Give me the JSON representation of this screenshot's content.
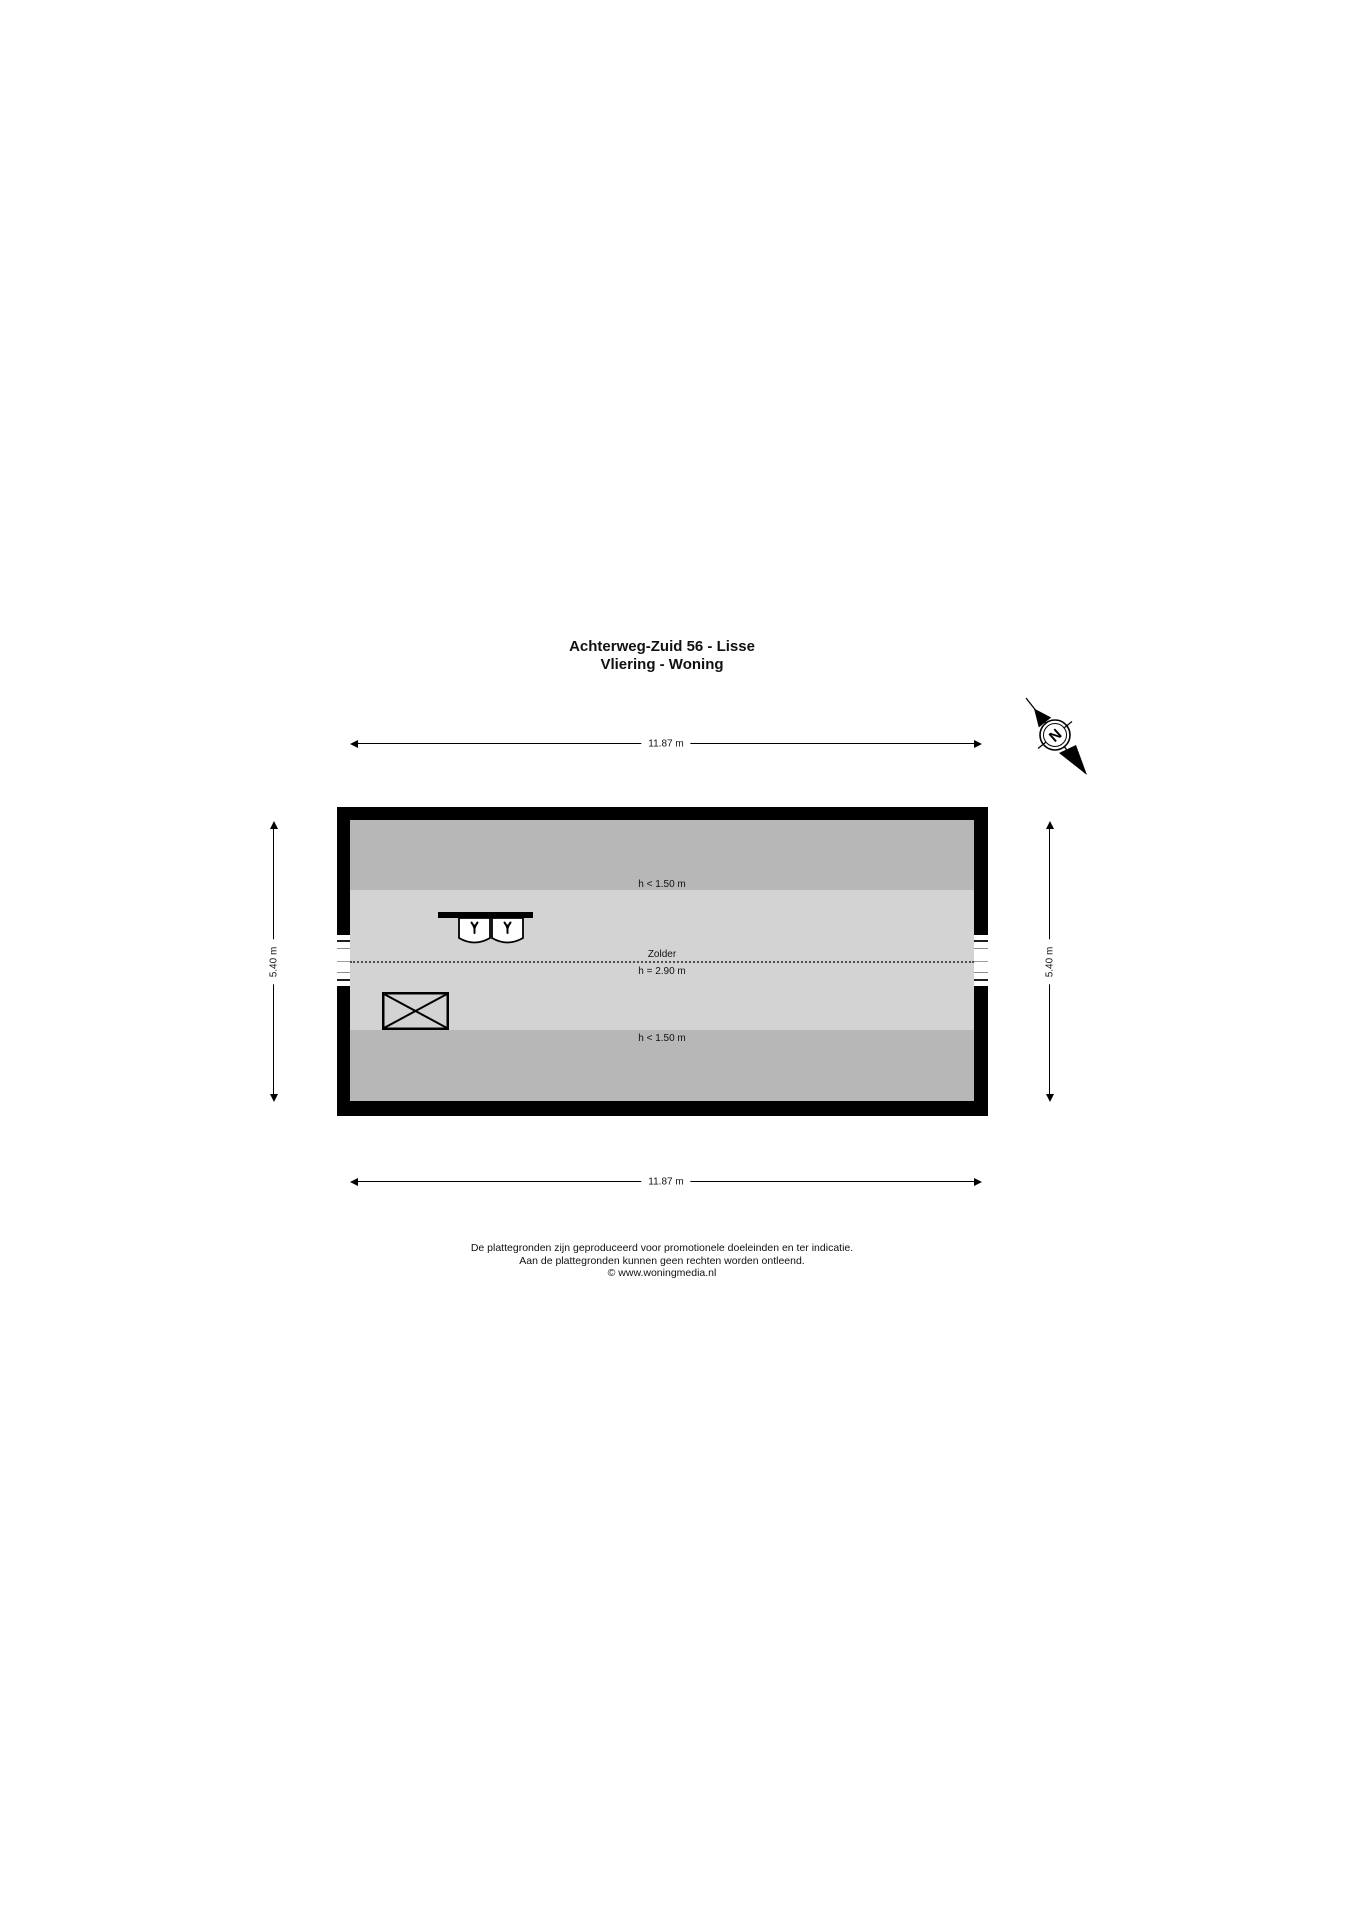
{
  "title": {
    "line1": "Achterweg-Zuid 56 - Lisse",
    "line2": "Vliering - Woning"
  },
  "compass": {
    "north_label": "N"
  },
  "dimensions": {
    "width_top": "11.87 m",
    "width_bottom": "11.87 m",
    "height_left": "5.40 m",
    "height_right": "5.40 m"
  },
  "plan": {
    "room_label": "Zolder",
    "ridge_height_label": "h = 2.90 m",
    "low_headroom_top_label": "h < 1.50 m",
    "low_headroom_bottom_label": "h < 1.50 m",
    "colors": {
      "wall": "#000000",
      "floor": "#d3d3d3",
      "low_headroom_zone": "#b7b7b7"
    }
  },
  "footer": {
    "line1": "De plattegronden zijn geproduceerd voor promotionele doeleinden en ter indicatie.",
    "line2": "Aan de plattegronden kunnen geen rechten worden ontleend.",
    "line3": "© www.woningmedia.nl"
  }
}
